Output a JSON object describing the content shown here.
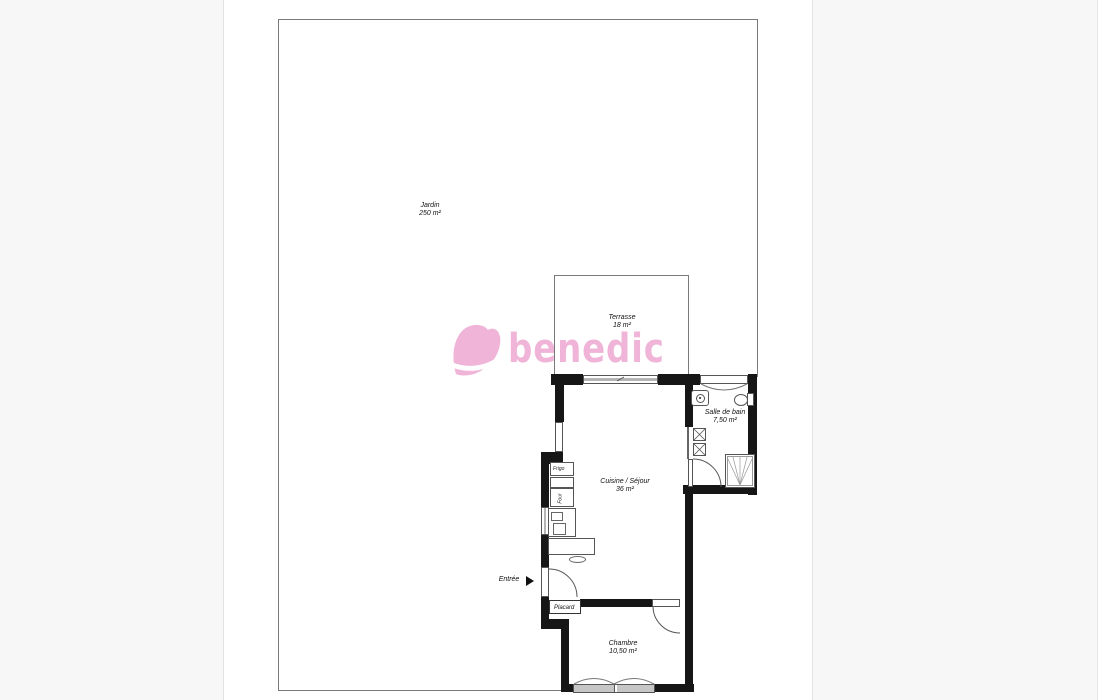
{
  "watermark": {
    "text": "benedic",
    "color": "#efb4d7"
  },
  "rooms": {
    "jardin": {
      "name": "Jardin",
      "area": "250 m²"
    },
    "terrasse": {
      "name": "Terrasse",
      "area": "18 m²"
    },
    "salle_de_bain": {
      "name": "Salle de bain",
      "area": "7,50 m²"
    },
    "cuisine_sejour": {
      "name": "Cuisine / Séjour",
      "area": "36 m²"
    },
    "chambre": {
      "name": "Chambre",
      "area": "10,50 m²"
    }
  },
  "fixtures": {
    "placard": "Placard",
    "frigo": "Frigo",
    "four": "Four"
  },
  "annotations": {
    "entree": "Entrée"
  },
  "colors": {
    "wall": "#161616",
    "thin_line": "#7a7a7a",
    "symbol_line": "#555555",
    "window_fill": "#c6c6c6",
    "page_background": "#ffffff",
    "margin_background": "#f7f7f7",
    "watermark_pink": "#efb4d7"
  }
}
